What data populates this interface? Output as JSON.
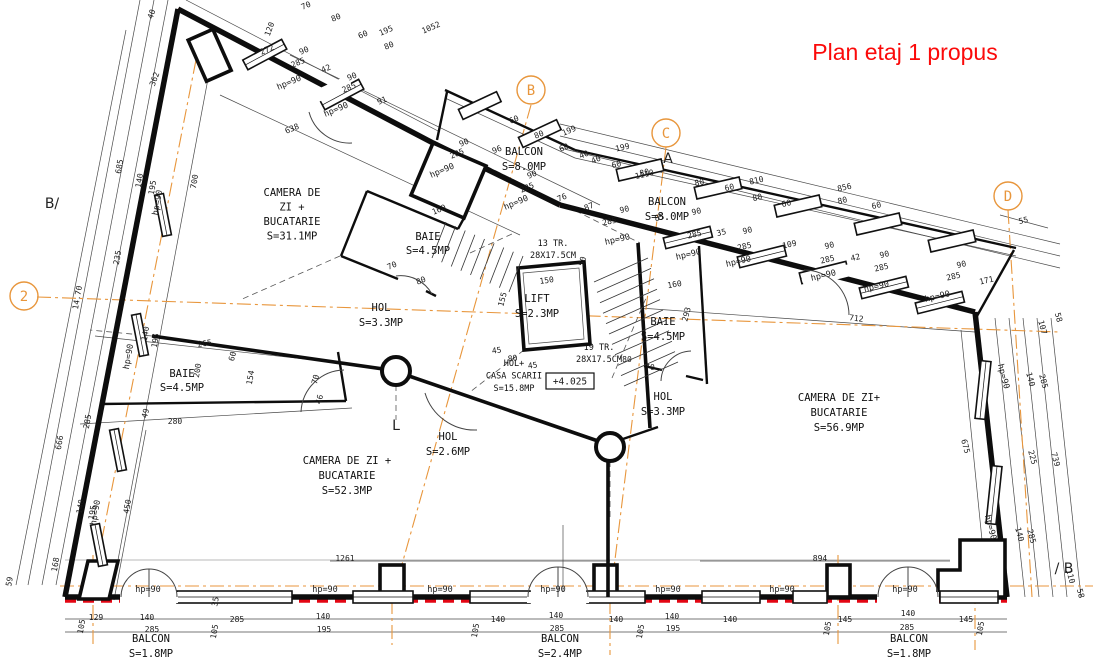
{
  "title": {
    "text": "Plan etaj 1 propus",
    "color": "#fb0a0a"
  },
  "colors": {
    "axis_orange": "#e8963c",
    "overlay_red": "#e30613",
    "wall_black": "#0d0d0d",
    "background": "#ffffff"
  },
  "hp_text": "hp=90",
  "elevation": {
    "text": "+4.025"
  },
  "grid_markers": [
    {
      "label": "2",
      "x": 24,
      "y": 296
    },
    {
      "label": "B",
      "x": 531,
      "y": 90
    },
    {
      "label": "C",
      "x": 666,
      "y": 133
    },
    {
      "label": "D",
      "x": 1008,
      "y": 196
    }
  ],
  "section_markers": [
    {
      "label": "B/",
      "x": 52,
      "y": 208
    },
    {
      "label": "/ B",
      "x": 1064,
      "y": 573
    },
    {
      "label": "A",
      "x": 668,
      "y": 163
    },
    {
      "label": "L",
      "x": 396,
      "y": 430
    }
  ],
  "rooms": [
    {
      "id": "camera-zi-1",
      "x": 292,
      "y": 196,
      "lh": 14.5,
      "lines": [
        "CAMERA DE",
        "ZI +",
        "BUCATARIE",
        "S=31.1MP"
      ]
    },
    {
      "id": "baie-1",
      "x": 428,
      "y": 240,
      "lh": 14,
      "lines": [
        "BAIE",
        "S=4.5MP"
      ]
    },
    {
      "id": "balcon-1",
      "x": 524,
      "y": 155,
      "lh": 15,
      "lines": [
        "BALCON",
        "S=8.0MP"
      ]
    },
    {
      "id": "balcon-2",
      "x": 667,
      "y": 205,
      "lh": 15,
      "lines": [
        "BALCON",
        "S=8.0MP"
      ]
    },
    {
      "id": "lift",
      "x": 537,
      "y": 302,
      "lh": 15,
      "lines": [
        "LIFT",
        "S=2.3MP"
      ]
    },
    {
      "id": "stairs-13",
      "x": 553,
      "y": 246,
      "lh": 12,
      "cls": "small",
      "lines": [
        "13 TR.",
        "28X17.5CM"
      ]
    },
    {
      "id": "stairs-19",
      "x": 599,
      "y": 350,
      "lh": 12,
      "cls": "small",
      "lines": [
        "19 TR.",
        "28X17.5CM"
      ]
    },
    {
      "id": "hol-1",
      "x": 381,
      "y": 311,
      "lh": 15,
      "lines": [
        "HOL",
        "S=3.3MP"
      ]
    },
    {
      "id": "hol-casa-scarii",
      "x": 514,
      "y": 366,
      "lh": 12.5,
      "cls": "small",
      "lines": [
        "HOL+",
        "CASA SCARII",
        "S=15.8MP"
      ]
    },
    {
      "id": "baie-2",
      "x": 182,
      "y": 377,
      "lh": 14,
      "lines": [
        "BAIE",
        "S=4.5MP"
      ]
    },
    {
      "id": "hol-2",
      "x": 448,
      "y": 440,
      "lh": 15,
      "lines": [
        "HOL",
        "S=2.6MP"
      ]
    },
    {
      "id": "camera-zi-2",
      "x": 347,
      "y": 464,
      "lh": 15,
      "lines": [
        "CAMERA DE ZI +",
        "BUCATARIE",
        "S=52.3MP"
      ]
    },
    {
      "id": "baie-3",
      "x": 663,
      "y": 325,
      "lh": 15,
      "lines": [
        "BAIE",
        "S=4.5MP"
      ]
    },
    {
      "id": "hol-3",
      "x": 663,
      "y": 400,
      "lh": 15,
      "lines": [
        "HOL",
        "S=3.3MP"
      ]
    },
    {
      "id": "camera-zi-3",
      "x": 839,
      "y": 401,
      "lh": 15,
      "lines": [
        "CAMERA DE ZI+",
        "BUCATARIE",
        "S=56.9MP"
      ]
    },
    {
      "id": "balcon-3",
      "x": 151,
      "y": 642,
      "lh": 15,
      "lines": [
        "BALCON",
        "S=1.8MP"
      ]
    },
    {
      "id": "balcon-4",
      "x": 560,
      "y": 642,
      "lh": 15,
      "lines": [
        "BALCON",
        "S=2.4MP"
      ]
    },
    {
      "id": "balcon-5",
      "x": 909,
      "y": 642,
      "lh": 15,
      "lines": [
        "BALCON",
        "S=1.8MP"
      ]
    }
  ],
  "hp_labels": [
    [
      290,
      85,
      -23
    ],
    [
      337,
      112,
      -23
    ],
    [
      443,
      173,
      -23
    ],
    [
      517,
      205,
      -23
    ],
    [
      618,
      242,
      -13
    ],
    [
      689,
      257,
      -13
    ],
    [
      739,
      264,
      -13
    ],
    [
      824,
      278,
      -13
    ],
    [
      877,
      289,
      -13
    ],
    [
      938,
      299,
      -13
    ],
    [
      1001,
      377,
      75
    ],
    [
      988,
      528,
      75
    ],
    [
      160,
      203,
      -80
    ],
    [
      131,
      357,
      -80
    ],
    [
      98,
      513,
      -80
    ],
    [
      148,
      592,
      0
    ],
    [
      325,
      592,
      0
    ],
    [
      440,
      592,
      0
    ],
    [
      553,
      592,
      0
    ],
    [
      668,
      592,
      0
    ],
    [
      782,
      592,
      0
    ],
    [
      905,
      592,
      0
    ]
  ],
  "dimensions": [
    [
      "272",
      268,
      52,
      -23
    ],
    [
      "1052",
      432,
      30,
      -23
    ],
    [
      "195",
      387,
      33,
      -23
    ],
    [
      "70",
      307,
      8,
      -23
    ],
    [
      "80",
      337,
      20,
      -23
    ],
    [
      "60",
      364,
      37,
      -23
    ],
    [
      "80",
      390,
      48,
      -23
    ],
    [
      "90",
      305,
      53,
      -23
    ],
    [
      "285",
      299,
      65,
      -23
    ],
    [
      "42",
      327,
      71,
      -23
    ],
    [
      "90",
      353,
      79,
      -23
    ],
    [
      "285",
      350,
      90,
      -23
    ],
    [
      "91",
      383,
      103,
      -23
    ],
    [
      "638",
      293,
      131,
      -23
    ],
    [
      "40",
      154,
      15,
      -70
    ],
    [
      "362",
      157,
      80,
      -70
    ],
    [
      "120",
      272,
      30,
      -70
    ],
    [
      "160",
      440,
      212,
      -23
    ],
    [
      "90",
      465,
      145,
      -23
    ],
    [
      "285",
      458,
      156,
      -23
    ],
    [
      "96",
      498,
      152,
      -23
    ],
    [
      "90",
      533,
      177,
      -23
    ],
    [
      "285",
      528,
      190,
      -23
    ],
    [
      "76",
      563,
      200,
      -23
    ],
    [
      "87",
      590,
      209,
      -23
    ],
    [
      "60",
      515,
      122,
      -23
    ],
    [
      "80",
      540,
      137,
      -23
    ],
    [
      "60",
      565,
      150,
      -23
    ],
    [
      "199",
      570,
      133,
      -23
    ],
    [
      "40",
      585,
      157,
      -23
    ],
    [
      "40",
      597,
      162,
      -23
    ],
    [
      "199",
      623,
      150,
      -13
    ],
    [
      "1110",
      645,
      177,
      -13
    ],
    [
      "60",
      617,
      167,
      -13
    ],
    [
      "80",
      645,
      175,
      -13
    ],
    [
      "80",
      700,
      185,
      -13
    ],
    [
      "60",
      730,
      190,
      -13
    ],
    [
      "810",
      757,
      183,
      -13
    ],
    [
      "80",
      758,
      200,
      -13
    ],
    [
      "60",
      787,
      206,
      -13
    ],
    [
      "856",
      845,
      190,
      -13
    ],
    [
      "80",
      843,
      203,
      -13
    ],
    [
      "60",
      877,
      208,
      -13
    ],
    [
      "90",
      625,
      212,
      -13
    ],
    [
      "285",
      610,
      224,
      -13
    ],
    [
      "85",
      660,
      220,
      -13
    ],
    [
      "90",
      697,
      214,
      -13
    ],
    [
      "285",
      695,
      237,
      -13
    ],
    [
      "35",
      722,
      235,
      -13
    ],
    [
      "90",
      748,
      233,
      -13
    ],
    [
      "285",
      745,
      249,
      -13
    ],
    [
      "109",
      790,
      247,
      -13
    ],
    [
      "90",
      830,
      248,
      -13
    ],
    [
      "285",
      828,
      262,
      -13
    ],
    [
      "42",
      856,
      260,
      -13
    ],
    [
      "90",
      885,
      257,
      -13
    ],
    [
      "285",
      882,
      270,
      -13
    ],
    [
      "160",
      675,
      287,
      -10
    ],
    [
      "55",
      1024,
      223,
      -13
    ],
    [
      "90",
      962,
      267,
      -13
    ],
    [
      "285",
      954,
      279,
      -13
    ],
    [
      "171",
      987,
      283,
      -13
    ],
    [
      "712",
      856,
      321,
      7
    ],
    [
      "293",
      689,
      315,
      -75
    ],
    [
      "80",
      627,
      362,
      0
    ],
    [
      "70",
      650,
      370,
      0
    ],
    [
      "107",
      1040,
      328,
      75
    ],
    [
      "58",
      1056,
      318,
      75
    ],
    [
      "140",
      1028,
      380,
      75
    ],
    [
      "285",
      1041,
      382,
      75
    ],
    [
      "225",
      1030,
      458,
      75
    ],
    [
      "739",
      1053,
      460,
      75
    ],
    [
      "675",
      963,
      447,
      75
    ],
    [
      "140",
      1017,
      535,
      75
    ],
    [
      "285",
      1029,
      537,
      75
    ],
    [
      "110",
      1068,
      577,
      75
    ],
    [
      "58",
      1078,
      594,
      75
    ],
    [
      "685",
      122,
      167,
      -80
    ],
    [
      "140",
      142,
      181,
      -80
    ],
    [
      "195",
      155,
      188,
      -80
    ],
    [
      "700",
      197,
      182,
      -80
    ],
    [
      "235",
      120,
      258,
      -80
    ],
    [
      "14.70",
      80,
      298,
      -80
    ],
    [
      "140",
      148,
      334,
      -80
    ],
    [
      "195",
      158,
      341,
      -80
    ],
    [
      "285",
      90,
      422,
      -80
    ],
    [
      "666",
      62,
      443,
      -80
    ],
    [
      "140",
      83,
      507,
      -80
    ],
    [
      "195",
      95,
      513,
      -80
    ],
    [
      "450",
      130,
      507,
      -80
    ],
    [
      "168",
      58,
      565,
      -80
    ],
    [
      "59",
      12,
      582,
      -80
    ],
    [
      "200",
      200,
      371,
      -80
    ],
    [
      "154",
      253,
      378,
      -80
    ],
    [
      "265",
      205,
      346,
      -8
    ],
    [
      "280",
      175,
      424,
      0
    ],
    [
      "70",
      393,
      268,
      -23
    ],
    [
      "80",
      422,
      283,
      -23
    ],
    [
      "70",
      318,
      380,
      -75
    ],
    [
      "46",
      322,
      400,
      -75
    ],
    [
      "49",
      148,
      414,
      -75
    ],
    [
      "60",
      235,
      357,
      -75
    ],
    [
      "150",
      547,
      283,
      -8
    ],
    [
      "155",
      505,
      300,
      -75
    ],
    [
      "45",
      497,
      353,
      -8
    ],
    [
      "80",
      513,
      361,
      -8
    ],
    [
      "45",
      533,
      368,
      -8
    ],
    [
      "50",
      585,
      262,
      -75
    ],
    [
      "1261",
      345,
      561,
      0
    ],
    [
      "894",
      820,
      561,
      0
    ],
    [
      "129",
      96,
      620,
      0
    ],
    [
      "140",
      147,
      620,
      0
    ],
    [
      "285",
      152,
      632,
      0
    ],
    [
      "105",
      84,
      627,
      -80
    ],
    [
      "105",
      217,
      632,
      -80
    ],
    [
      "285",
      237,
      622,
      0
    ],
    [
      "35",
      218,
      602,
      -80
    ],
    [
      "140",
      323,
      619,
      0
    ],
    [
      "195",
      324,
      632,
      0
    ],
    [
      "105",
      478,
      631,
      -80
    ],
    [
      "140",
      498,
      622,
      0
    ],
    [
      "140",
      556,
      618,
      0
    ],
    [
      "285",
      557,
      631,
      0
    ],
    [
      "140",
      616,
      622,
      0
    ],
    [
      "105",
      643,
      632,
      -80
    ],
    [
      "140",
      672,
      619,
      0
    ],
    [
      "195",
      673,
      631,
      0
    ],
    [
      "140",
      730,
      622,
      0
    ],
    [
      "145",
      845,
      622,
      0
    ],
    [
      "105",
      830,
      629,
      -80
    ],
    [
      "140",
      908,
      616,
      0
    ],
    [
      "285",
      907,
      630,
      0
    ],
    [
      "145",
      966,
      622,
      0
    ],
    [
      "105",
      983,
      629,
      -80
    ]
  ]
}
